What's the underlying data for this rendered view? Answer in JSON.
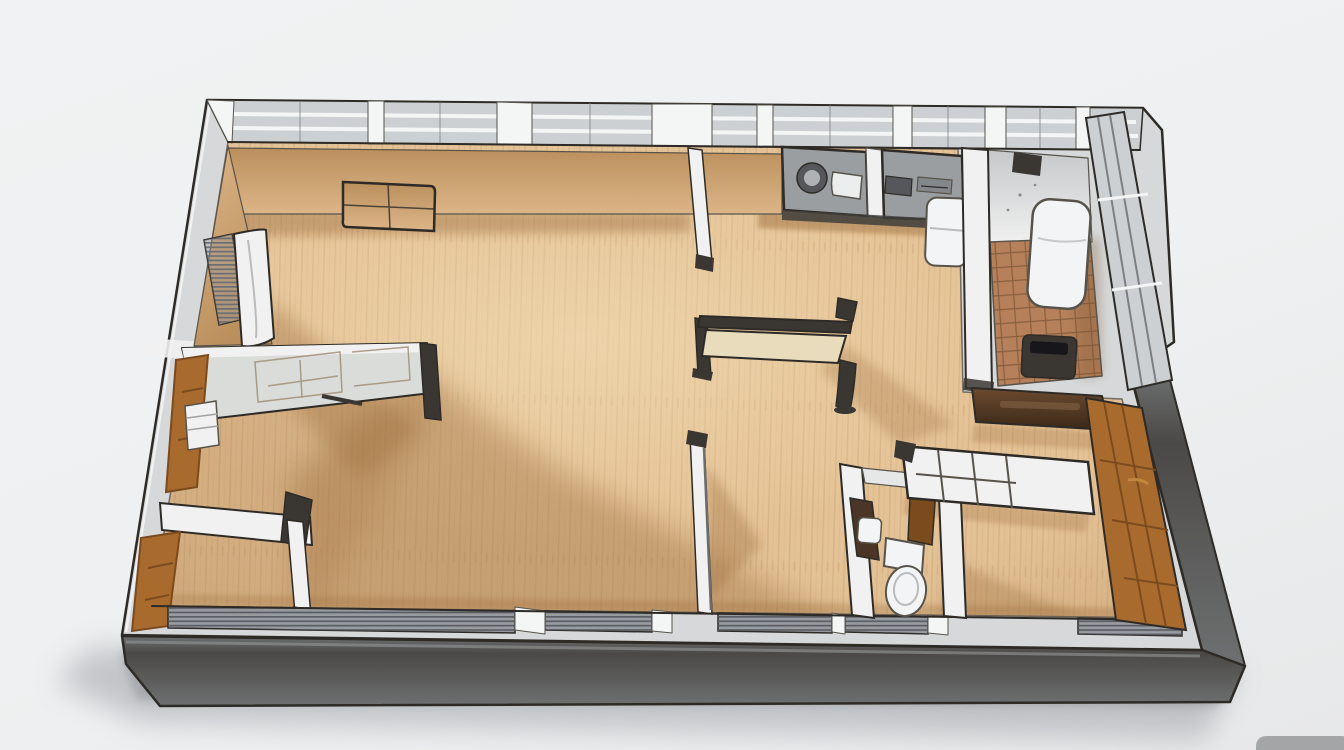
{
  "scene": {
    "kind": "isometric-3d-floor-plan-rendering",
    "style": "sketch-photoreal cutaway apartment model viewed from above at an oblique angle, no text labels",
    "rooms": [
      {
        "name": "bedroom-top-left",
        "floor": "light-wood",
        "features": [
          "tan-inner-walls",
          "window-blinds",
          "white-door-panel",
          "wall-mounted-folding-panel"
        ]
      },
      {
        "name": "living-room",
        "floor": "light-wood",
        "features": [
          "dark-frame-bench-table",
          "large-floor-shadow"
        ]
      },
      {
        "name": "kitchen",
        "floor": "light-wood",
        "features": [
          "gray-counter-with-round-burner",
          "white-sink",
          "cooktop-counter",
          "white-water-heater"
        ]
      },
      {
        "name": "balcony-bathroom",
        "floor": "terracotta-tile",
        "features": [
          "white-boiler",
          "waste-bin",
          "sliding-glass-wall",
          "dark-brown-ledge"
        ]
      },
      {
        "name": "room-middle-left",
        "floor": "light-wood",
        "features": [
          "glazed-sketch-partition",
          "wood-wardrobe-door",
          "white-shelf"
        ]
      },
      {
        "name": "room-bottom-left",
        "floor": "light-wood",
        "features": [
          "wood-door",
          "dark-wall-cabinet",
          "white-partition"
        ]
      },
      {
        "name": "wc",
        "floor": "light-wood",
        "features": [
          "toilet",
          "wash-basin",
          "open-wood-door"
        ]
      },
      {
        "name": "bedroom-bottom-right",
        "floor": "light-wood",
        "features": [
          "glazed-grid-panel",
          "tall-wood-wardrobe"
        ]
      },
      {
        "name": "hallway",
        "floor": "light-wood"
      }
    ],
    "building_features": [
      "continuous-window-band-top-wall",
      "radiator-grilles-bottom-sill",
      "dark-plinth-base",
      "soft-drop-shadow",
      "corner-object-bottom-right"
    ]
  },
  "colors": {
    "bgTop": "#f1f2f3",
    "bgMid": "#eef0f1",
    "bgBottom": "#e7e8e9",
    "blob": "#a3a5a7",
    "outline": "#2e2b27",
    "outlineSoft": "#57534b",
    "wallTop": "#d6d8d9",
    "wallFace": "#c6c8ca",
    "wallWhite": "#f1f1f1",
    "glazing": "#cdd0d2",
    "windowFrame": "#f4f5f5",
    "tanDark": "#ba8f5c",
    "tanLight": "#dcb588",
    "floorWood": "#e4c296",
    "floorLight": "#f3dcb2",
    "plankLine": "#c39a6a",
    "floorShadow": "#9e7040",
    "tile": "#b5805a",
    "tileGrout": "#7e5636",
    "plinthDark": "#4b4947",
    "plinthMid": "#6e7071",
    "plinthLight": "#909293",
    "counter": "#9b9ea0",
    "counterDark": "#55575a",
    "sinkWhite": "#eceded",
    "appliance": "#f3f4f5",
    "darkFurn": "#3a3733",
    "tableTop": "#e8dcbc",
    "woodDoor": "#a96a2e",
    "woodDoorDark": "#7c4b1d",
    "woodDoorLight": "#c3863e",
    "blindBase": "#989ba0",
    "blindStripe": "#53565c",
    "ledgeLight": "#6b4a30",
    "ledgeDark": "#3a2817",
    "shadow": "#8f9398"
  }
}
